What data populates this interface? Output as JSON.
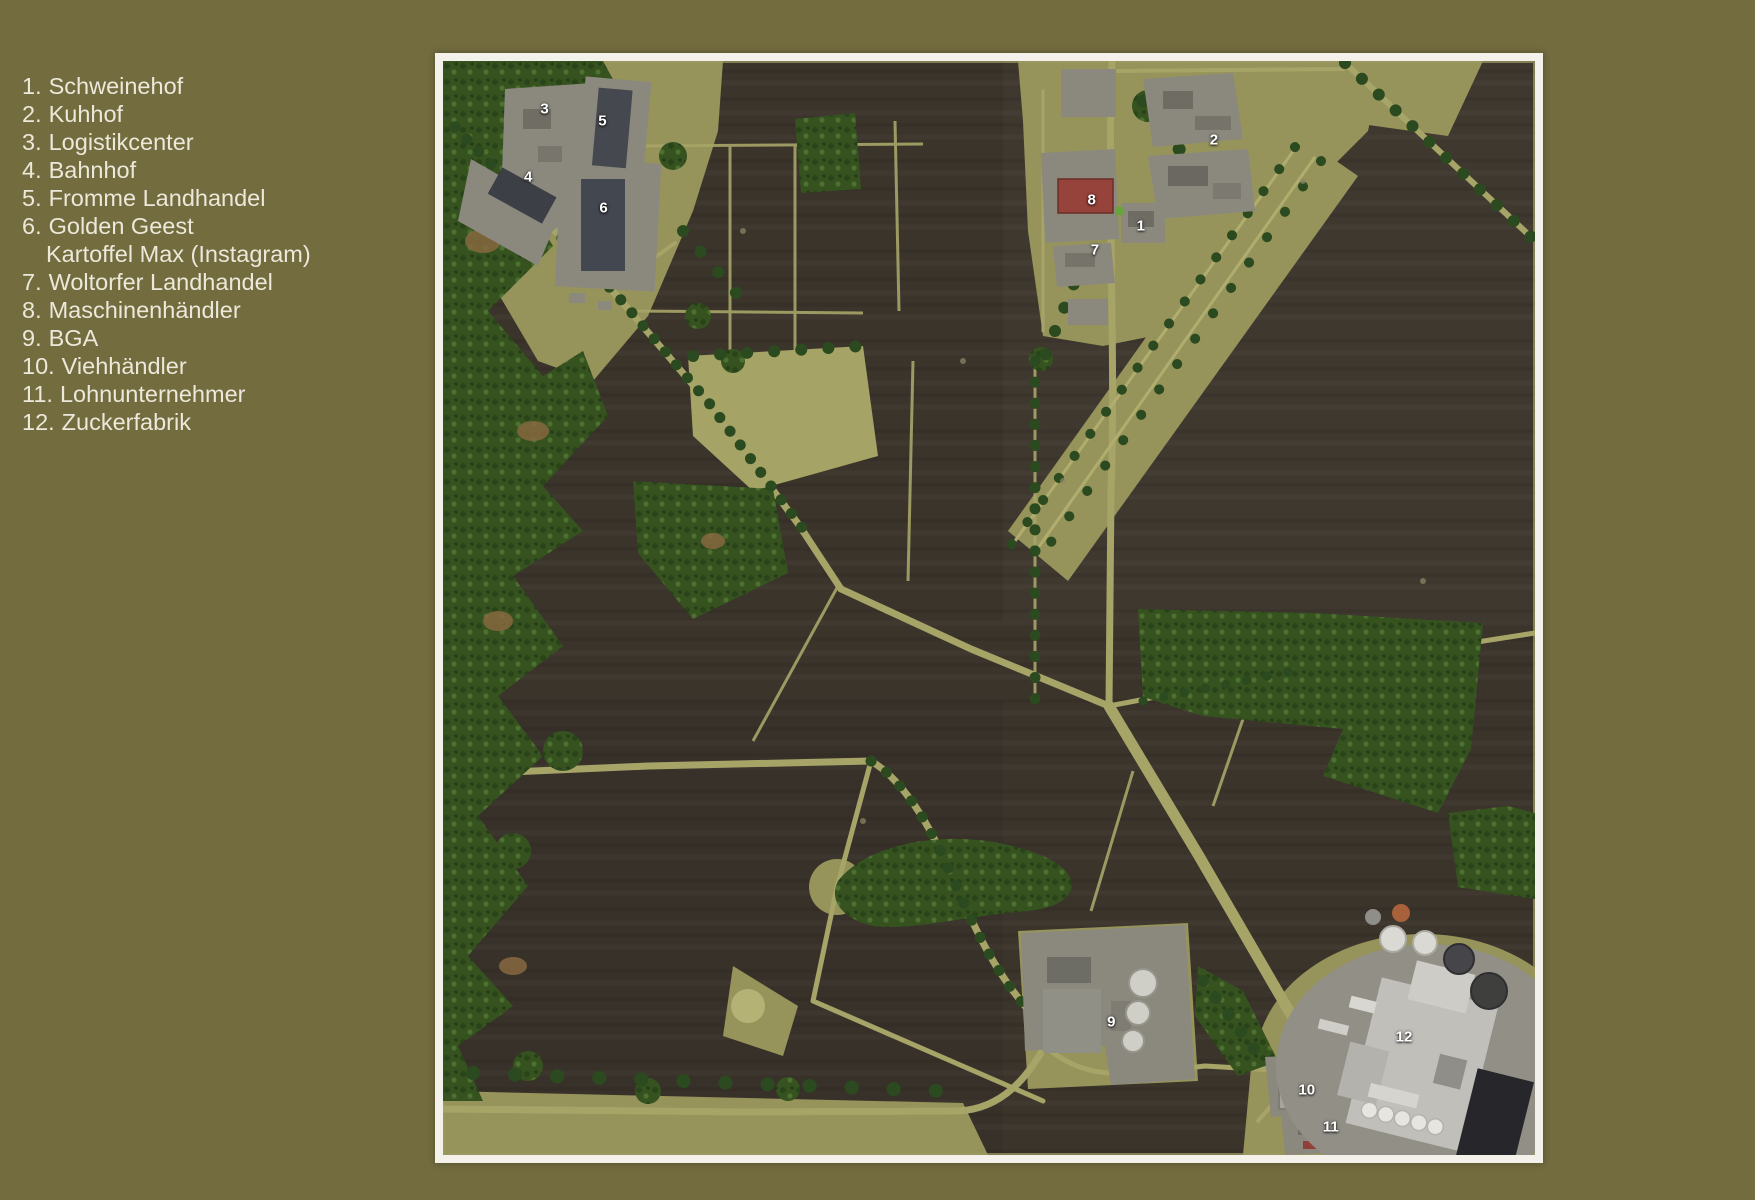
{
  "theme": {
    "page_bg": "#736C3F",
    "frame": "#F3F1EA",
    "field": "#3B342B",
    "grass": "#96945B",
    "meadow": "#A5A365",
    "road": "#A7A468",
    "forest": "#35521F",
    "forest_dark": "#2C4A1F",
    "dirt": "#86683F",
    "pad": "#8B897E",
    "red": "#96433B",
    "legend_text": "#ECE8DA",
    "marker": "#FFFFFF"
  },
  "legend": {
    "items": [
      {
        "num": "1.",
        "label": "Schweinehof"
      },
      {
        "num": "2.",
        "label": "Kuhhof"
      },
      {
        "num": "3.",
        "label": "Logistikcenter"
      },
      {
        "num": "4.",
        "label": "Bahnhof"
      },
      {
        "num": "5.",
        "label": "Fromme Landhandel"
      },
      {
        "num": "6.",
        "label": "Golden Geest",
        "sub": "Kartoffel Max (Instagram)"
      },
      {
        "num": "7.",
        "label": "Woltorfer Landhandel"
      },
      {
        "num": "8.",
        "label": "Maschinenhändler"
      },
      {
        "num": "9.",
        "label": "BGA"
      },
      {
        "num": "10.",
        "label": "Viehhändler"
      },
      {
        "num": "11.",
        "label": "Lohnunternehmer"
      },
      {
        "num": "12.",
        "label": "Zuckerfabrik"
      }
    ]
  },
  "map": {
    "markers": [
      {
        "id": "1",
        "x": 63.9,
        "y": 15.1
      },
      {
        "id": "2",
        "x": 70.6,
        "y": 7.2
      },
      {
        "id": "3",
        "x": 9.3,
        "y": 4.4
      },
      {
        "id": "4",
        "x": 7.8,
        "y": 10.6
      },
      {
        "id": "5",
        "x": 14.6,
        "y": 5.5
      },
      {
        "id": "6",
        "x": 14.7,
        "y": 13.4
      },
      {
        "id": "7",
        "x": 59.7,
        "y": 17.3
      },
      {
        "id": "8",
        "x": 59.4,
        "y": 12.7
      },
      {
        "id": "9",
        "x": 61.2,
        "y": 87.8
      },
      {
        "id": "10",
        "x": 79.1,
        "y": 94.1
      },
      {
        "id": "11",
        "x": 81.3,
        "y": 97.4
      },
      {
        "id": "12",
        "x": 88.0,
        "y": 89.2
      }
    ]
  }
}
